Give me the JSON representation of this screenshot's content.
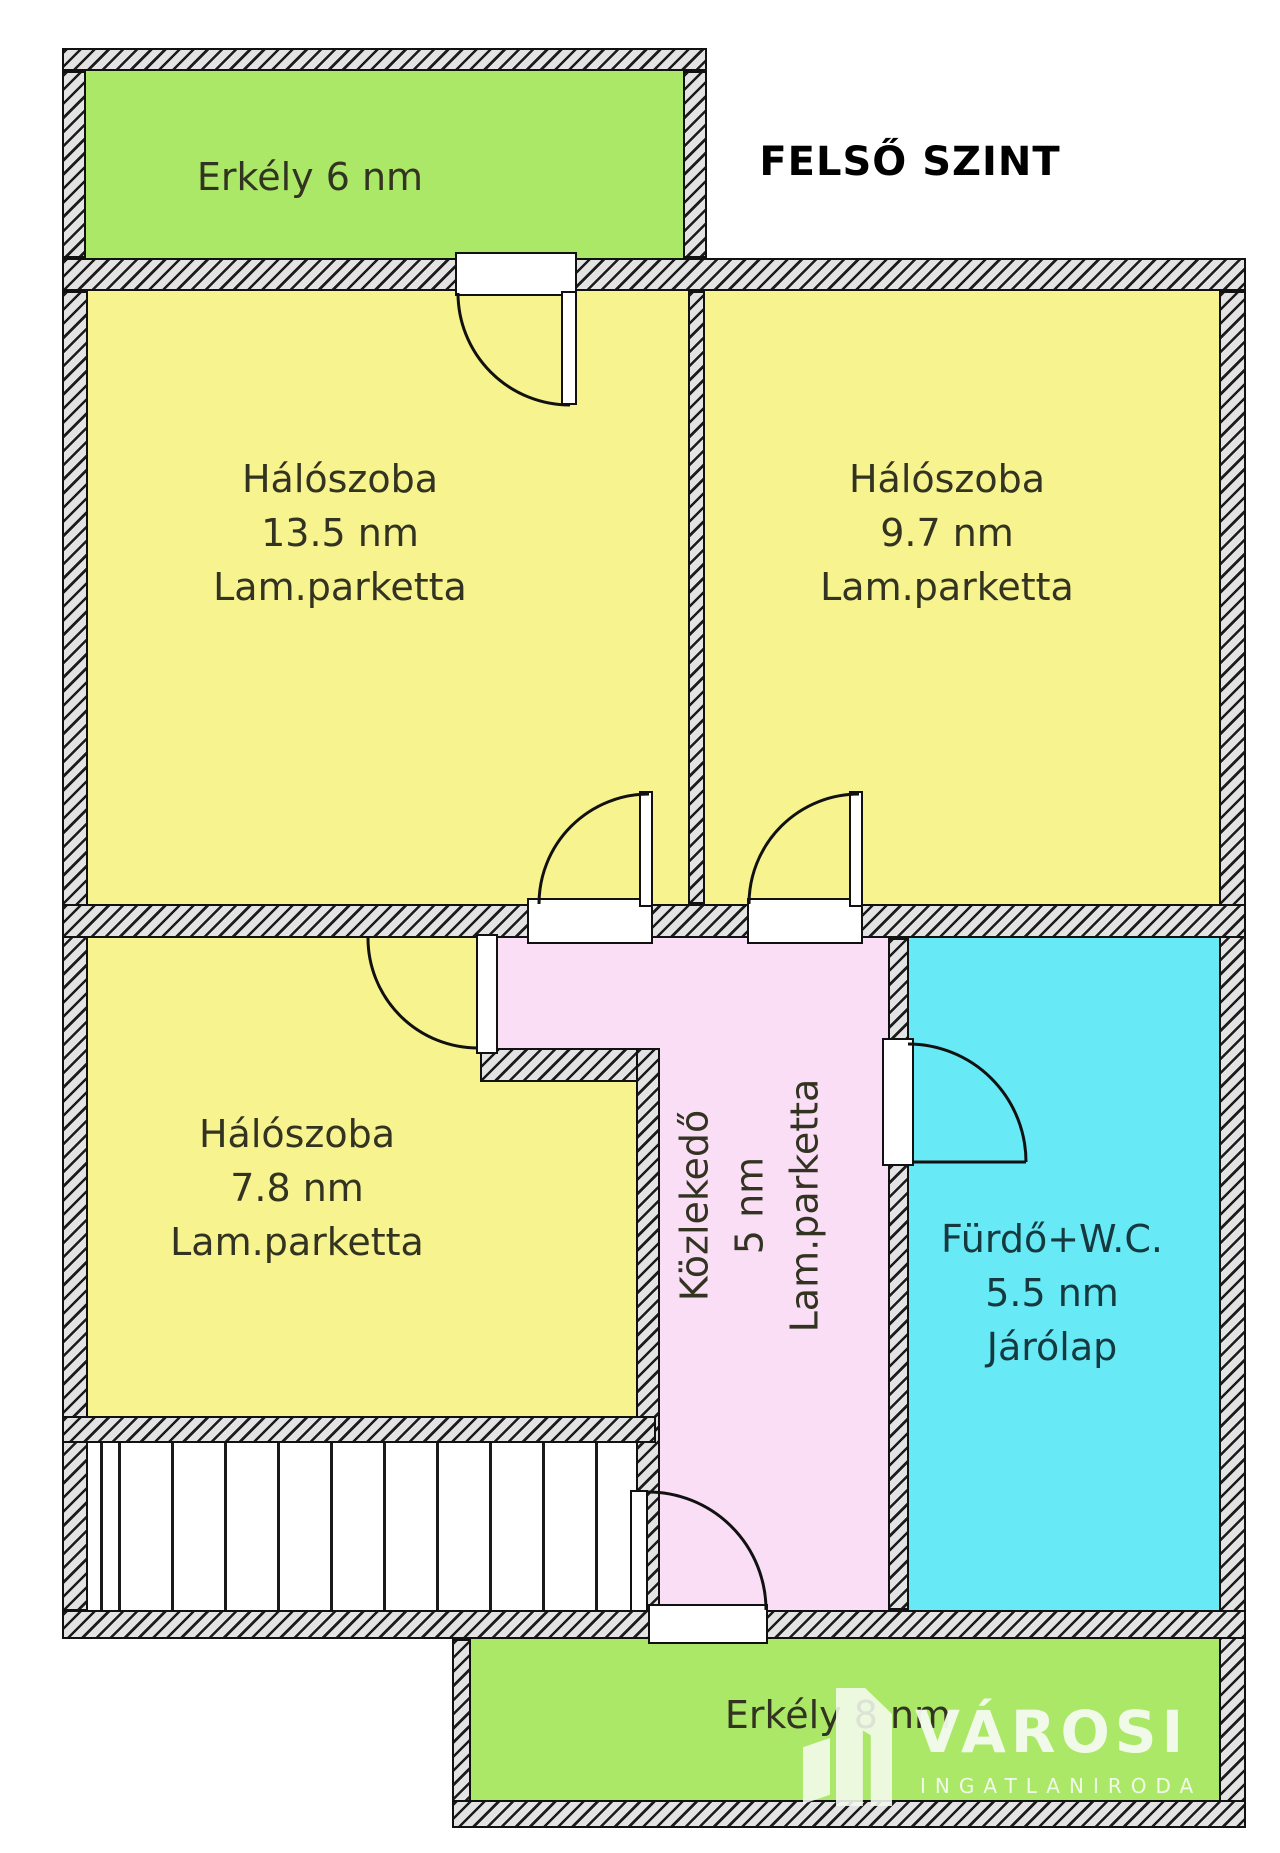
{
  "title": "FELSŐ SZINT",
  "rooms": {
    "balcony_top": {
      "label": "Erkély 6 nm"
    },
    "bedroom_large": {
      "name": "Hálószoba",
      "area": "13.5 nm",
      "floor": "Lam.parketta"
    },
    "bedroom_right": {
      "name": "Hálószoba",
      "area": "9.7 nm",
      "floor": "Lam.parketta"
    },
    "bedroom_small": {
      "name": "Hálószoba",
      "area": "7.8 nm",
      "floor": "Lam.parketta"
    },
    "hallway": {
      "name": "Közlekedő",
      "area": "5 nm",
      "floor": "Lam.parketta"
    },
    "bathroom": {
      "name": "Fürdő+W.C.",
      "area": "5.5 nm",
      "floor": "Járólap"
    },
    "balcony_bottom": {
      "label": "Erkély 8 nm"
    }
  },
  "watermark": {
    "brand": "VÁROSI",
    "subtitle": "INGATLANIRODA"
  },
  "colors": {
    "balcony": "#abe868",
    "room": "#f7f38f",
    "hallway": "#f9def5",
    "bathroom": "#67e9f6",
    "line": "#111111",
    "text": "#333322",
    "bathroom_text": "#15393e",
    "logo": "#f5fbef"
  }
}
